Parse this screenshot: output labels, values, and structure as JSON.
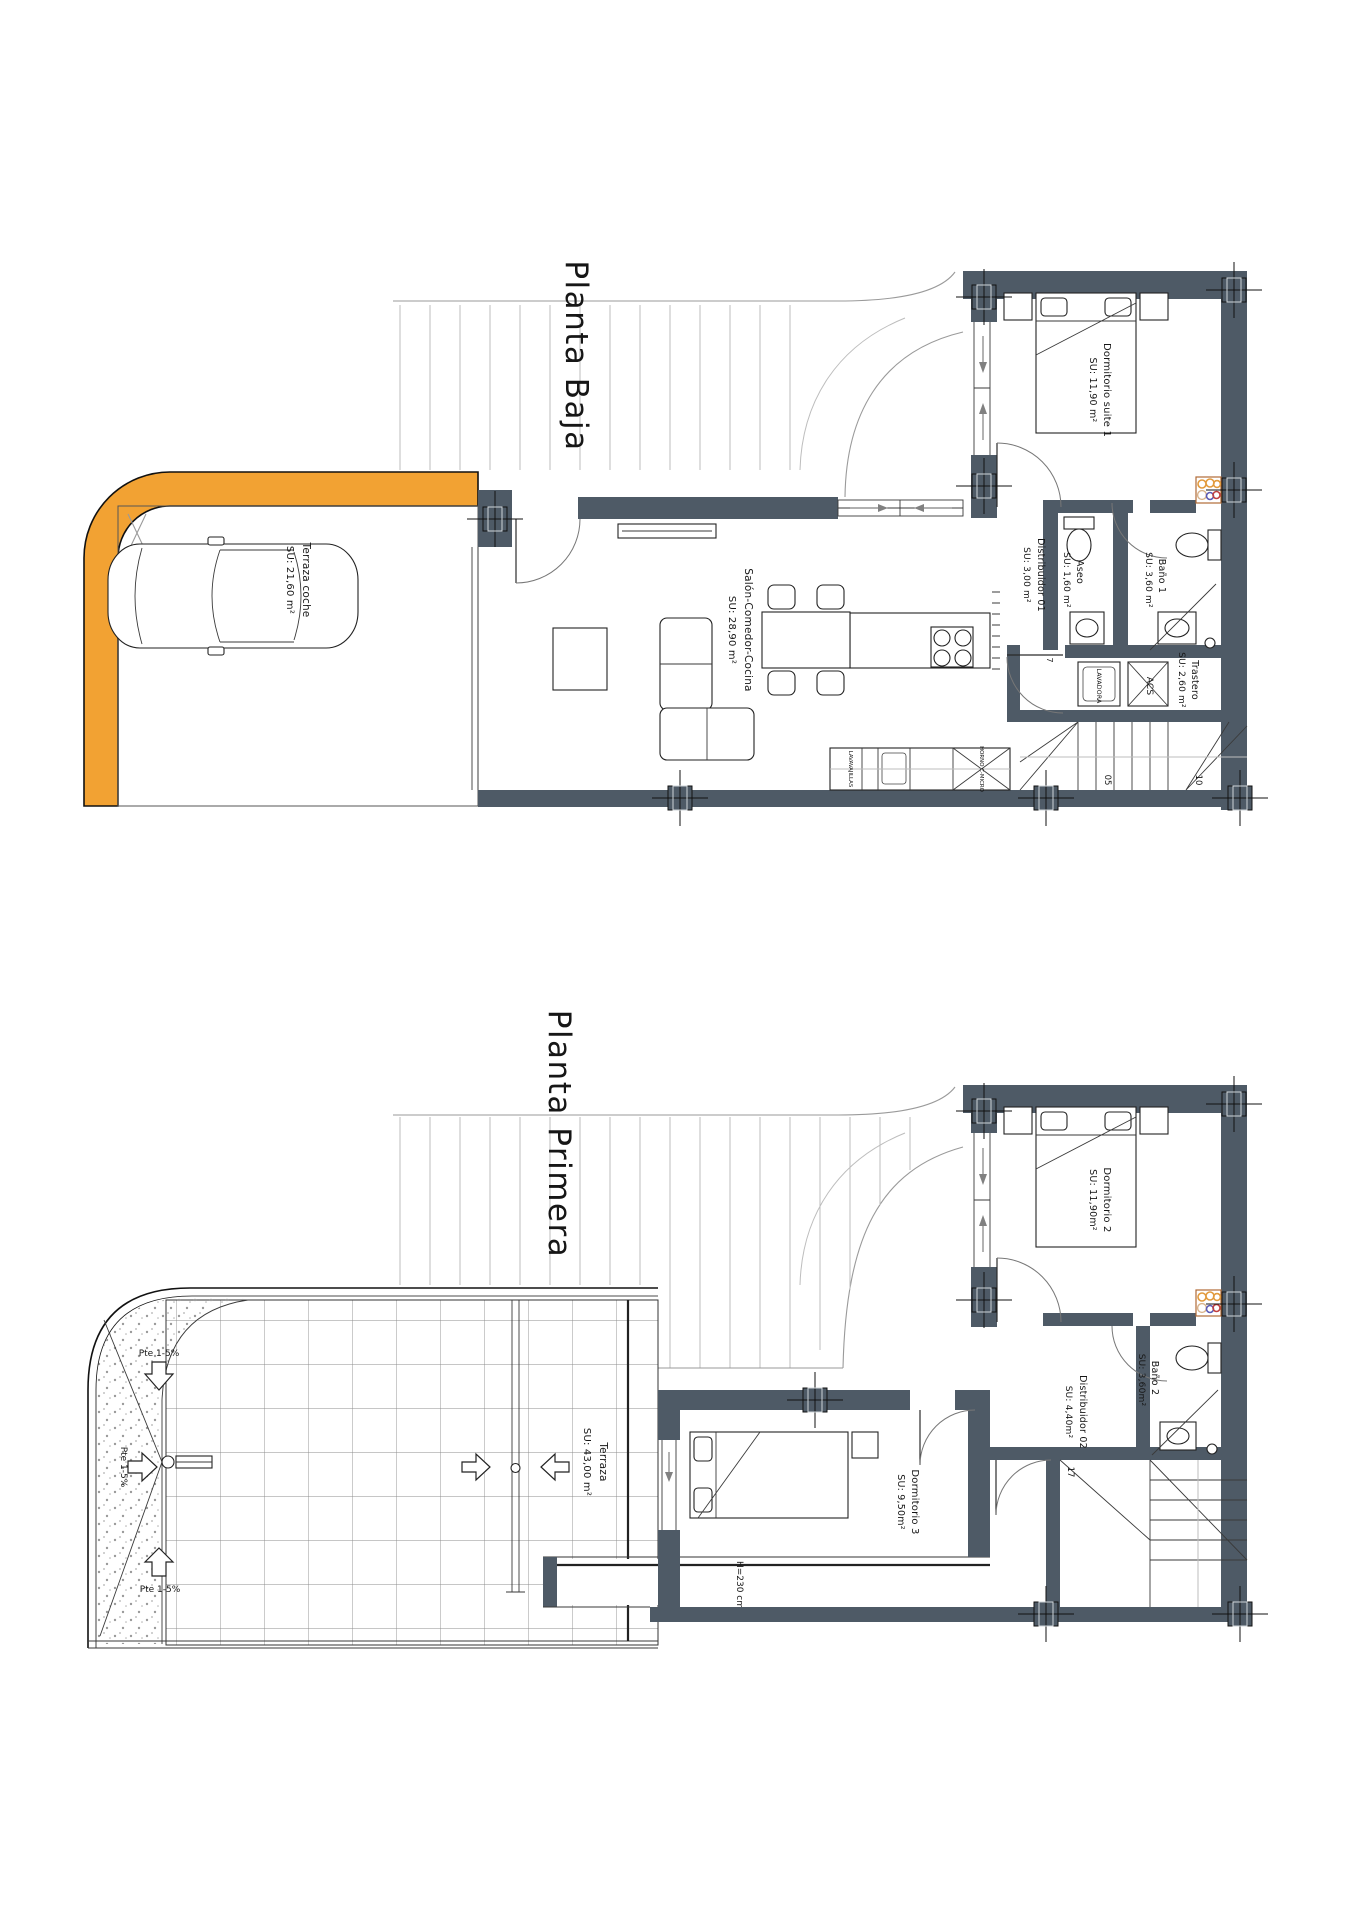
{
  "colors": {
    "wall": "#4E5A66",
    "carport_band": "#F2A233",
    "paper": "#FFFFFF"
  },
  "plans": {
    "baja": {
      "title": "Planta Baja",
      "rooms": {
        "carport": {
          "name": "Terraza coche",
          "area": "SU: 21,60 m²"
        },
        "living": {
          "name": "Salón-Comedor-Cocina",
          "area": "SU: 28,90 m²"
        },
        "hall": {
          "name": "Distribuidor 01",
          "area": "SU: 3,00 m²"
        },
        "toilet": {
          "name": "Aseo",
          "area": "SU: 1,60 m²"
        },
        "bath1": {
          "name": "Baño 1",
          "area": "SU: 3,60 m²"
        },
        "suite": {
          "name": "Dormitorio suite 1",
          "area": "SU: 11,90 m²"
        },
        "storage": {
          "name": "Trastero",
          "area": "SU: 2,60 m²"
        }
      },
      "appliances": {
        "washer": "LAVADORA",
        "water_heater": "ACS",
        "dishwasher": "LAVAVAJILLAS",
        "oven": "HORNO C-MICRO"
      },
      "stair_numbers": {
        "n05": "05",
        "n10": "10",
        "n7": "7"
      }
    },
    "primera": {
      "title": "Planta Primera",
      "rooms": {
        "terrace": {
          "name": "Terraza",
          "area": "SU: 43,00 m²"
        },
        "bedroom2": {
          "name": "Dormitorio 2",
          "area": "SU: 11,90m²"
        },
        "bath2": {
          "name": "Baño 2",
          "area": "SU: 3,60m²"
        },
        "hall": {
          "name": "Distribuidor 02",
          "area": "SU: 4,40m²"
        },
        "bedroom3": {
          "name": "Dormitorio 3",
          "area": "SU: 9,50m²"
        }
      },
      "slopes": {
        "top": "Pte 1-5%",
        "middle": "Pte 1-5%",
        "bottom": "Pte 1-5%"
      },
      "height_note": "H=230 cm",
      "stair_numbers": {
        "n17": "17"
      }
    }
  }
}
